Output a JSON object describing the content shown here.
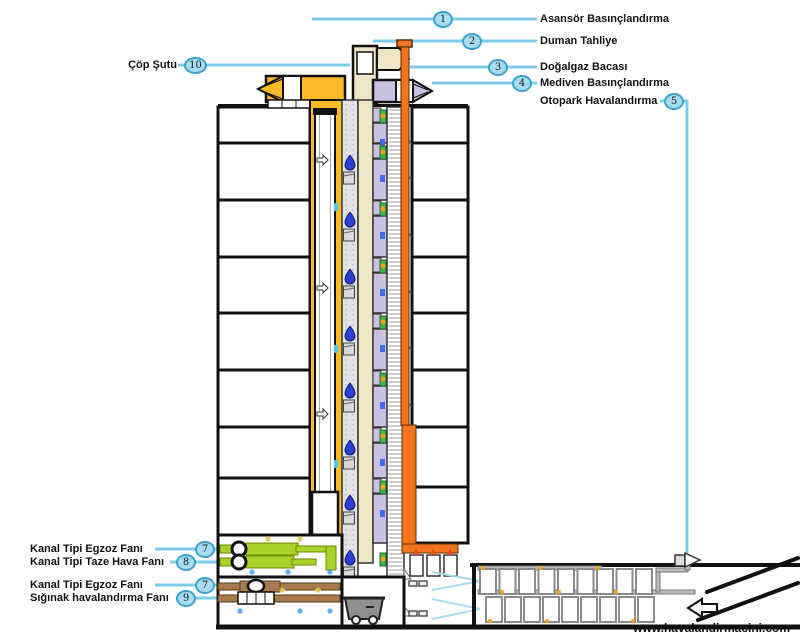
{
  "callouts": [
    {
      "num": "1",
      "label": "Asansör Basınçlandırma"
    },
    {
      "num": "2",
      "label": "Duman Tahliye"
    },
    {
      "num": "3",
      "label": "Doğalgaz Bacası"
    },
    {
      "num": "4",
      "label": "Mediven Basınçlandırma"
    },
    {
      "num": "5",
      "label": "Otopark Havalandırma"
    },
    {
      "num": "10",
      "label": "Çöp Şutu"
    },
    {
      "num": "7",
      "label": "Kanal Tipi Egzoz Fanı"
    },
    {
      "num": "8",
      "label": "Kanal Tipi Taze Hava Fanı"
    },
    {
      "num": "7",
      "label": "Kanal Tipi Egzoz Fanı"
    },
    {
      "num": "9",
      "label": "Sığınak havalandırma Fanı"
    }
  ],
  "website": {
    "label": "www.havalandirmacini.com"
  },
  "colors": {
    "callout_line": "#7FCCEA",
    "callout_bubble_fill": "#A8DCF1",
    "callout_bubble_border": "#3D9FCB",
    "elevator_shaft_yellow": "#FDB927",
    "smoke_shaft_beige": "#EFE6C5",
    "stair_shaft_purple": "#C9C0E4",
    "gas_flue_orange": "#F4751F",
    "duct_fan_green": "#A9D329",
    "shelter_duct_brown": "#A87B4F",
    "garbage_bag_blue": "#2B3FD4",
    "chute_gray": "#E3E3E3",
    "door_green": "#3CB54A",
    "knob_orange": "#F5A31A"
  }
}
